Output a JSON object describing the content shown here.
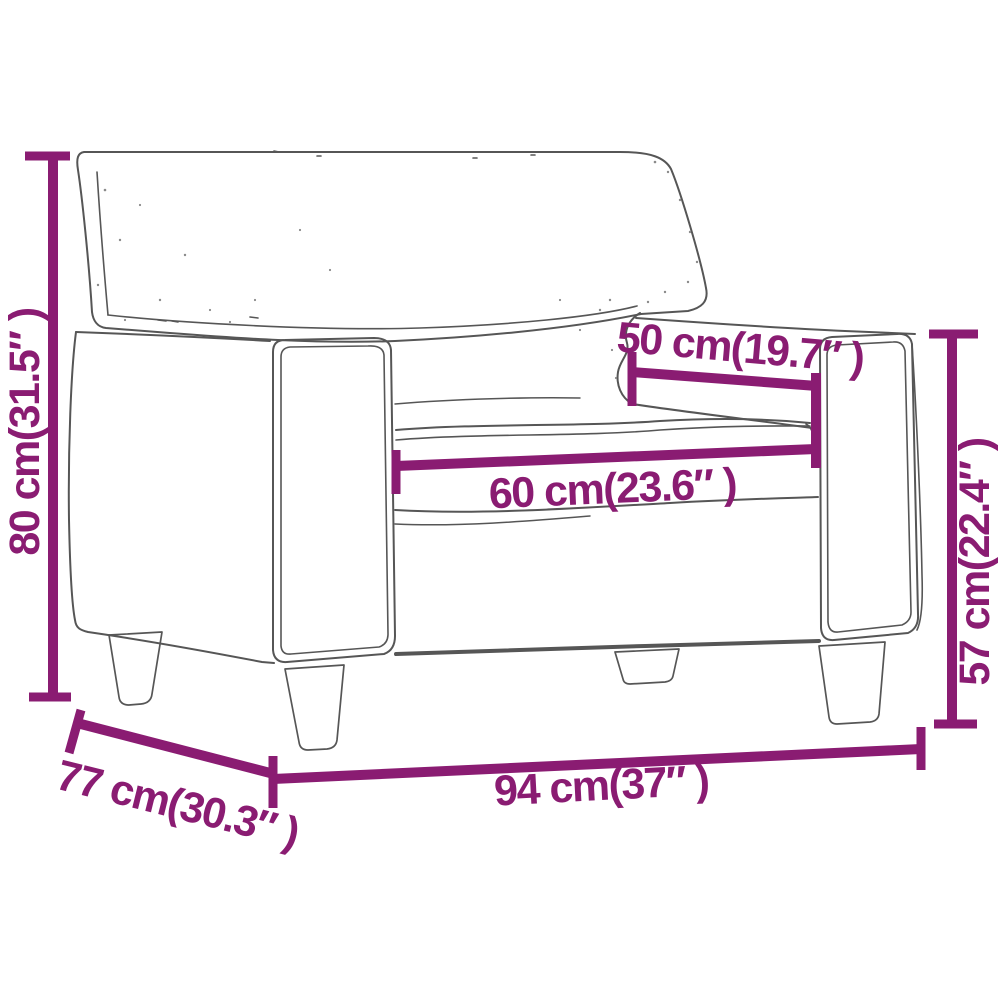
{
  "colors": {
    "accent": "#8a1c72",
    "sketch": "#565656",
    "background": "#ffffff"
  },
  "diagram": {
    "subject": "armchair",
    "dimensions": {
      "height": {
        "label": "80 cm(31.5″ )",
        "cm": "80",
        "inches": "31.5"
      },
      "seat_depth": {
        "label": "50 cm(19.7″ )",
        "cm": "50",
        "inches": "19.7"
      },
      "seat_width": {
        "label": "60 cm(23.6″ )",
        "cm": "60",
        "inches": "23.6"
      },
      "arm_height": {
        "label": "57 cm(22.4″ )",
        "cm": "57",
        "inches": "22.4"
      },
      "width": {
        "label": "94 cm(37″ )",
        "cm": "94",
        "inches": "37"
      },
      "depth": {
        "label": "77 cm(30.3″ )",
        "cm": "77",
        "inches": "30.3"
      }
    }
  }
}
